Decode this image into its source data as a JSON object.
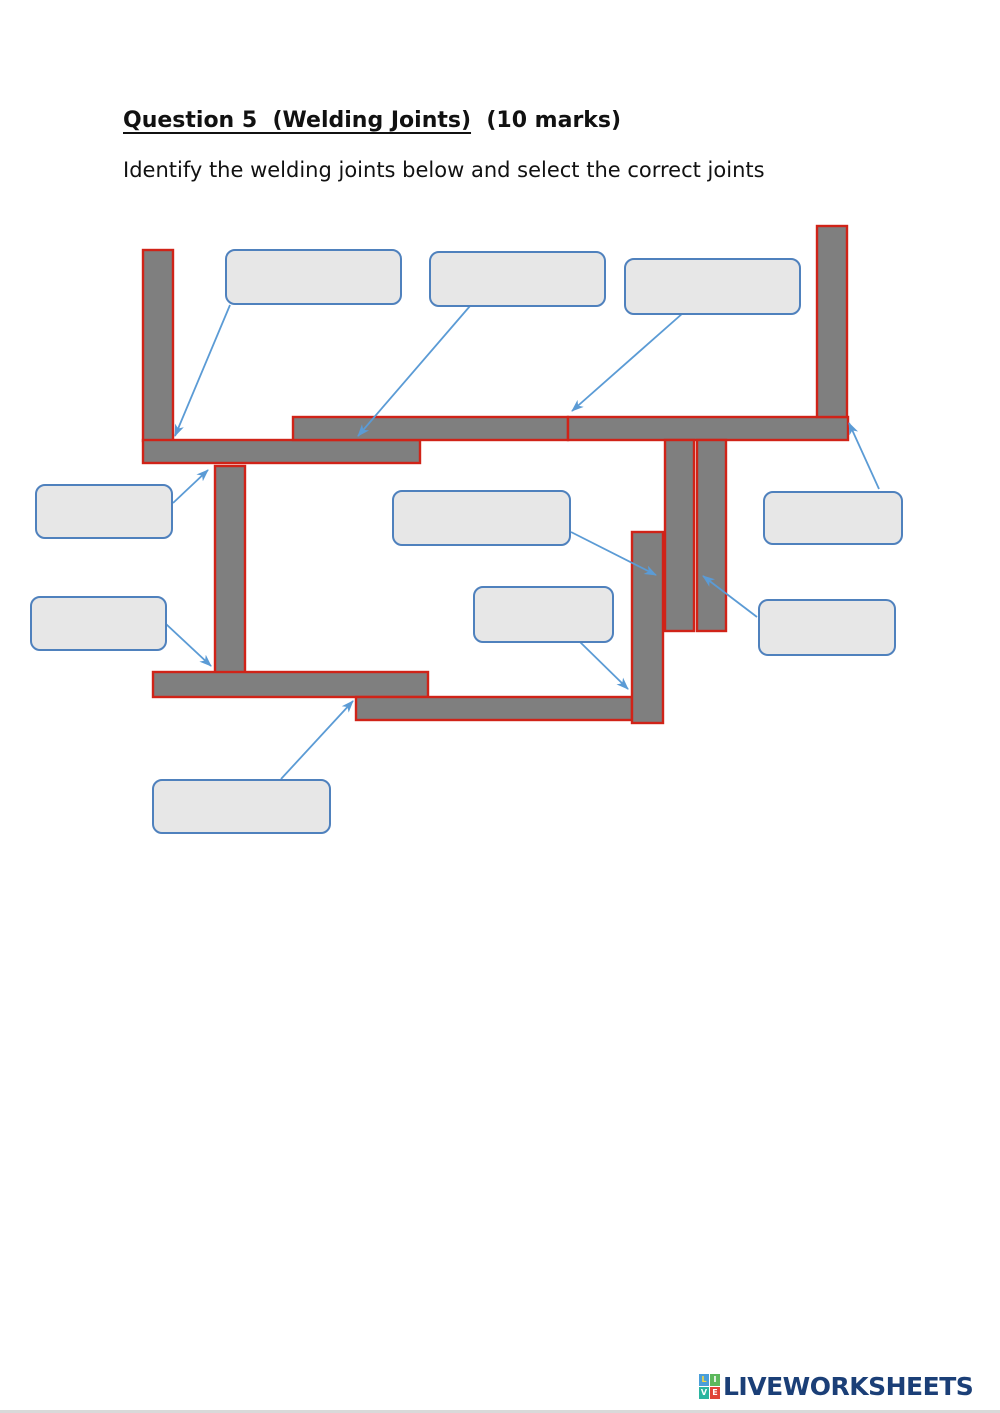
{
  "page": {
    "title_underlined": "Question 5  (Welding Joints)",
    "title_suffix": "  (10 marks)",
    "instruction": "Identify the welding joints below and select the correct joints"
  },
  "answer_boxes": [
    {
      "id": 1,
      "value": ""
    },
    {
      "id": 2,
      "value": ""
    },
    {
      "id": 3,
      "value": ""
    },
    {
      "id": 4,
      "value": ""
    },
    {
      "id": 5,
      "value": ""
    },
    {
      "id": 6,
      "value": ""
    },
    {
      "id": 7,
      "value": ""
    },
    {
      "id": 8,
      "value": ""
    },
    {
      "id": 9,
      "value": ""
    },
    {
      "id": 10,
      "value": ""
    }
  ],
  "footer": {
    "logo_text": "LIVEWORKSHEETS",
    "logo_grid": [
      {
        "letter": "L"
      },
      {
        "letter": "I"
      },
      {
        "letter": "V"
      },
      {
        "letter": "E"
      }
    ]
  },
  "colors": {
    "bar_fill": "#7f7f7f",
    "bar_outline": "#d02318",
    "box_fill": "#e7e7e7",
    "box_border": "#4f81bd",
    "arrow": "#5b9bd5",
    "logo_text": "#1b3f77",
    "text": "#111111",
    "background": "#ffffff",
    "logo_sq_l": "#4a9ed9",
    "logo_sq_i": "#5cb85c",
    "logo_sq_v": "#2bb5a0",
    "logo_sq_e": "#e04438",
    "logo_letter_l": "#f7d93f",
    "logo_letter": "#ffffff"
  }
}
